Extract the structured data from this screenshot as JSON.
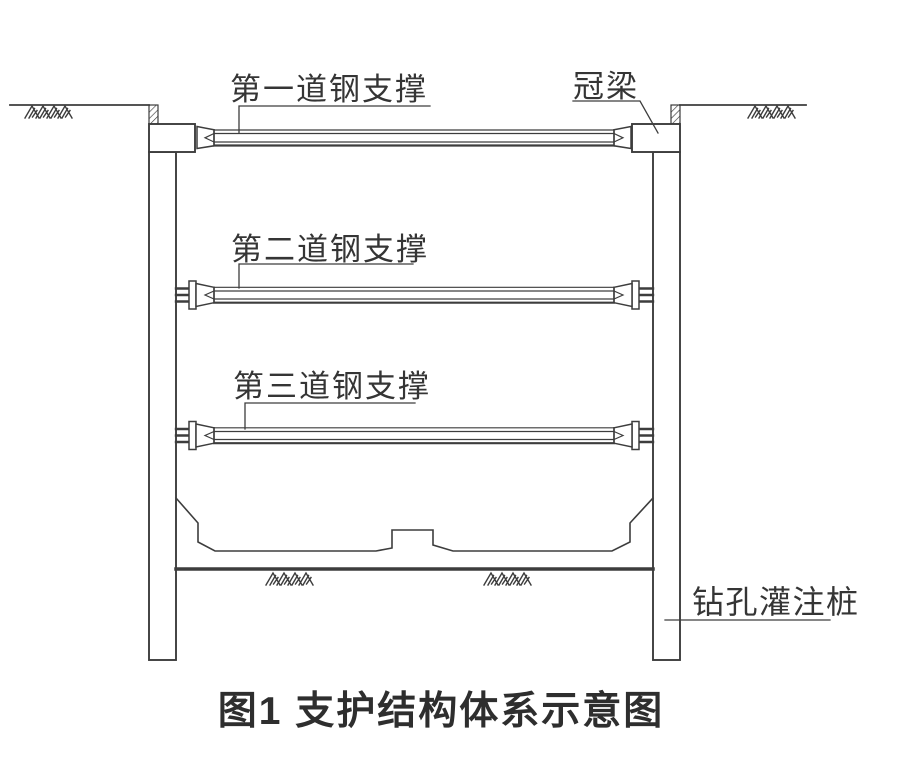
{
  "figure": {
    "caption": "图1  支护结构体系示意图",
    "labels": {
      "strut1": "第一道钢支撑",
      "strut2": "第二道钢支撑",
      "strut3": "第三道钢支撑",
      "crown_beam": "冠梁",
      "bored_pile": "钻孔灌注桩"
    },
    "colors": {
      "line": "#3d3d3d",
      "text": "#353535",
      "background": "#ffffff"
    }
  }
}
